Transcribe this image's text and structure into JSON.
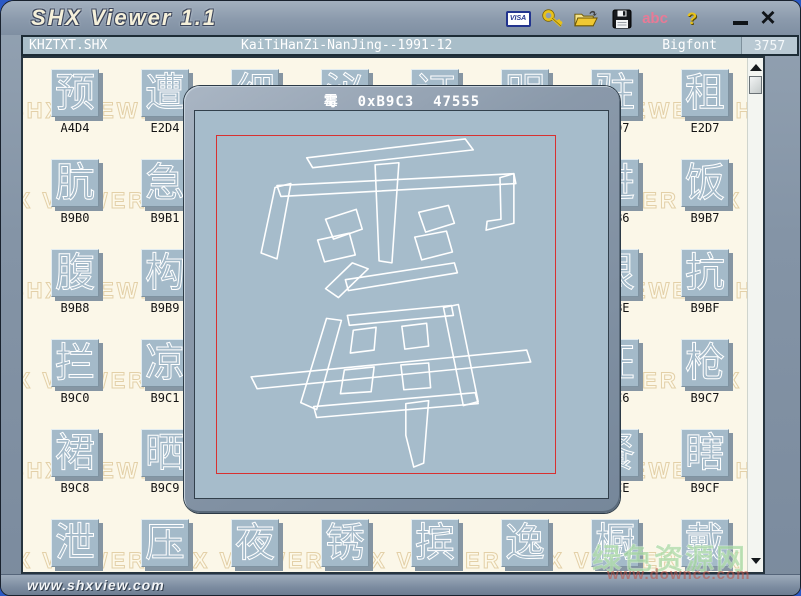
{
  "titlebar": {
    "title": "SHX Viewer 1.1",
    "visa_label": "VISA",
    "abc_label": "abc",
    "help_label": "?",
    "close_glyph": "×"
  },
  "statusbar": {
    "filename": "KHZTXT.SHX",
    "font_description": "KaiTiHanZi-NanJing--1991-12",
    "font_type": "Bigfont",
    "glyph_count": "3757"
  },
  "background_watermark": {
    "text": "SHX VIEWER",
    "repeat": 6,
    "row_offsets": [
      -14,
      -44,
      -14,
      -44,
      -14,
      -44
    ]
  },
  "grid": {
    "tiles": [
      {
        "row": 0,
        "col": 0,
        "char": "预",
        "code": "A4D4"
      },
      {
        "row": 0,
        "col": 1,
        "char": "遭",
        "code": "E2D4"
      },
      {
        "row": 0,
        "col": 2,
        "char": "细",
        "code": ""
      },
      {
        "row": 0,
        "col": 3,
        "char": "泌",
        "code": ""
      },
      {
        "row": 0,
        "col": 4,
        "char": "订",
        "code": ""
      },
      {
        "row": 0,
        "col": 5,
        "char": "明",
        "code": ""
      },
      {
        "row": 0,
        "col": 6,
        "char": "驻",
        "code": "A4D7"
      },
      {
        "row": 0,
        "col": 7,
        "char": "租",
        "code": "E2D7"
      },
      {
        "row": 1,
        "col": 0,
        "char": "肮",
        "code": "B9B0"
      },
      {
        "row": 1,
        "col": 1,
        "char": "急",
        "code": "B9B1"
      },
      {
        "row": 1,
        "col": 6,
        "char": "进",
        "code": "B9B6"
      },
      {
        "row": 1,
        "col": 7,
        "char": "饭",
        "code": "B9B7"
      },
      {
        "row": 2,
        "col": 0,
        "char": "腹",
        "code": "B9B8"
      },
      {
        "row": 2,
        "col": 1,
        "char": "构",
        "code": "B9B9"
      },
      {
        "row": 2,
        "col": 6,
        "char": "很",
        "code": "B9BE"
      },
      {
        "row": 2,
        "col": 7,
        "char": "抗",
        "code": "B9BF"
      },
      {
        "row": 3,
        "col": 0,
        "char": "拦",
        "code": "B9C0"
      },
      {
        "row": 3,
        "col": 1,
        "char": "凉",
        "code": "B9C1"
      },
      {
        "row": 3,
        "col": 6,
        "char": "汪",
        "code": "B9C6"
      },
      {
        "row": 3,
        "col": 7,
        "char": "枪",
        "code": "B9C7"
      },
      {
        "row": 4,
        "col": 0,
        "char": "裙",
        "code": "B9C8"
      },
      {
        "row": 4,
        "col": 1,
        "char": "晒",
        "code": "B9C9"
      },
      {
        "row": 4,
        "col": 6,
        "char": "餐",
        "code": "B9CE"
      },
      {
        "row": 4,
        "col": 7,
        "char": "瞎",
        "code": "B9CF"
      },
      {
        "row": 5,
        "col": 0,
        "char": "泄",
        "code": ""
      },
      {
        "row": 5,
        "col": 1,
        "char": "压",
        "code": ""
      },
      {
        "row": 5,
        "col": 2,
        "char": "夜",
        "code": ""
      },
      {
        "row": 5,
        "col": 3,
        "char": "锈",
        "code": ""
      },
      {
        "row": 5,
        "col": 4,
        "char": "摈",
        "code": ""
      },
      {
        "row": 5,
        "col": 5,
        "char": "逸",
        "code": ""
      },
      {
        "row": 5,
        "col": 6,
        "char": "橱",
        "code": ""
      },
      {
        "row": 5,
        "col": 7,
        "char": "戴",
        "code": ""
      }
    ]
  },
  "dialog": {
    "char": "霉",
    "hex_code": "0xB9C3",
    "dec_code": "47555"
  },
  "footer": {
    "url": "www.shxview.com"
  },
  "site_watermark": {
    "line1": "绿色资源网",
    "line2": "www.downcc.com"
  },
  "colors": {
    "tile_bg": "#a4bac9",
    "content_bg": "#fbf7e8",
    "frame": "#8494a6",
    "red_bounding_box": "#d83030",
    "abc_pink": "#e87a96",
    "gold": "#e8c21a",
    "desktop_blue": "#2b59c5"
  }
}
